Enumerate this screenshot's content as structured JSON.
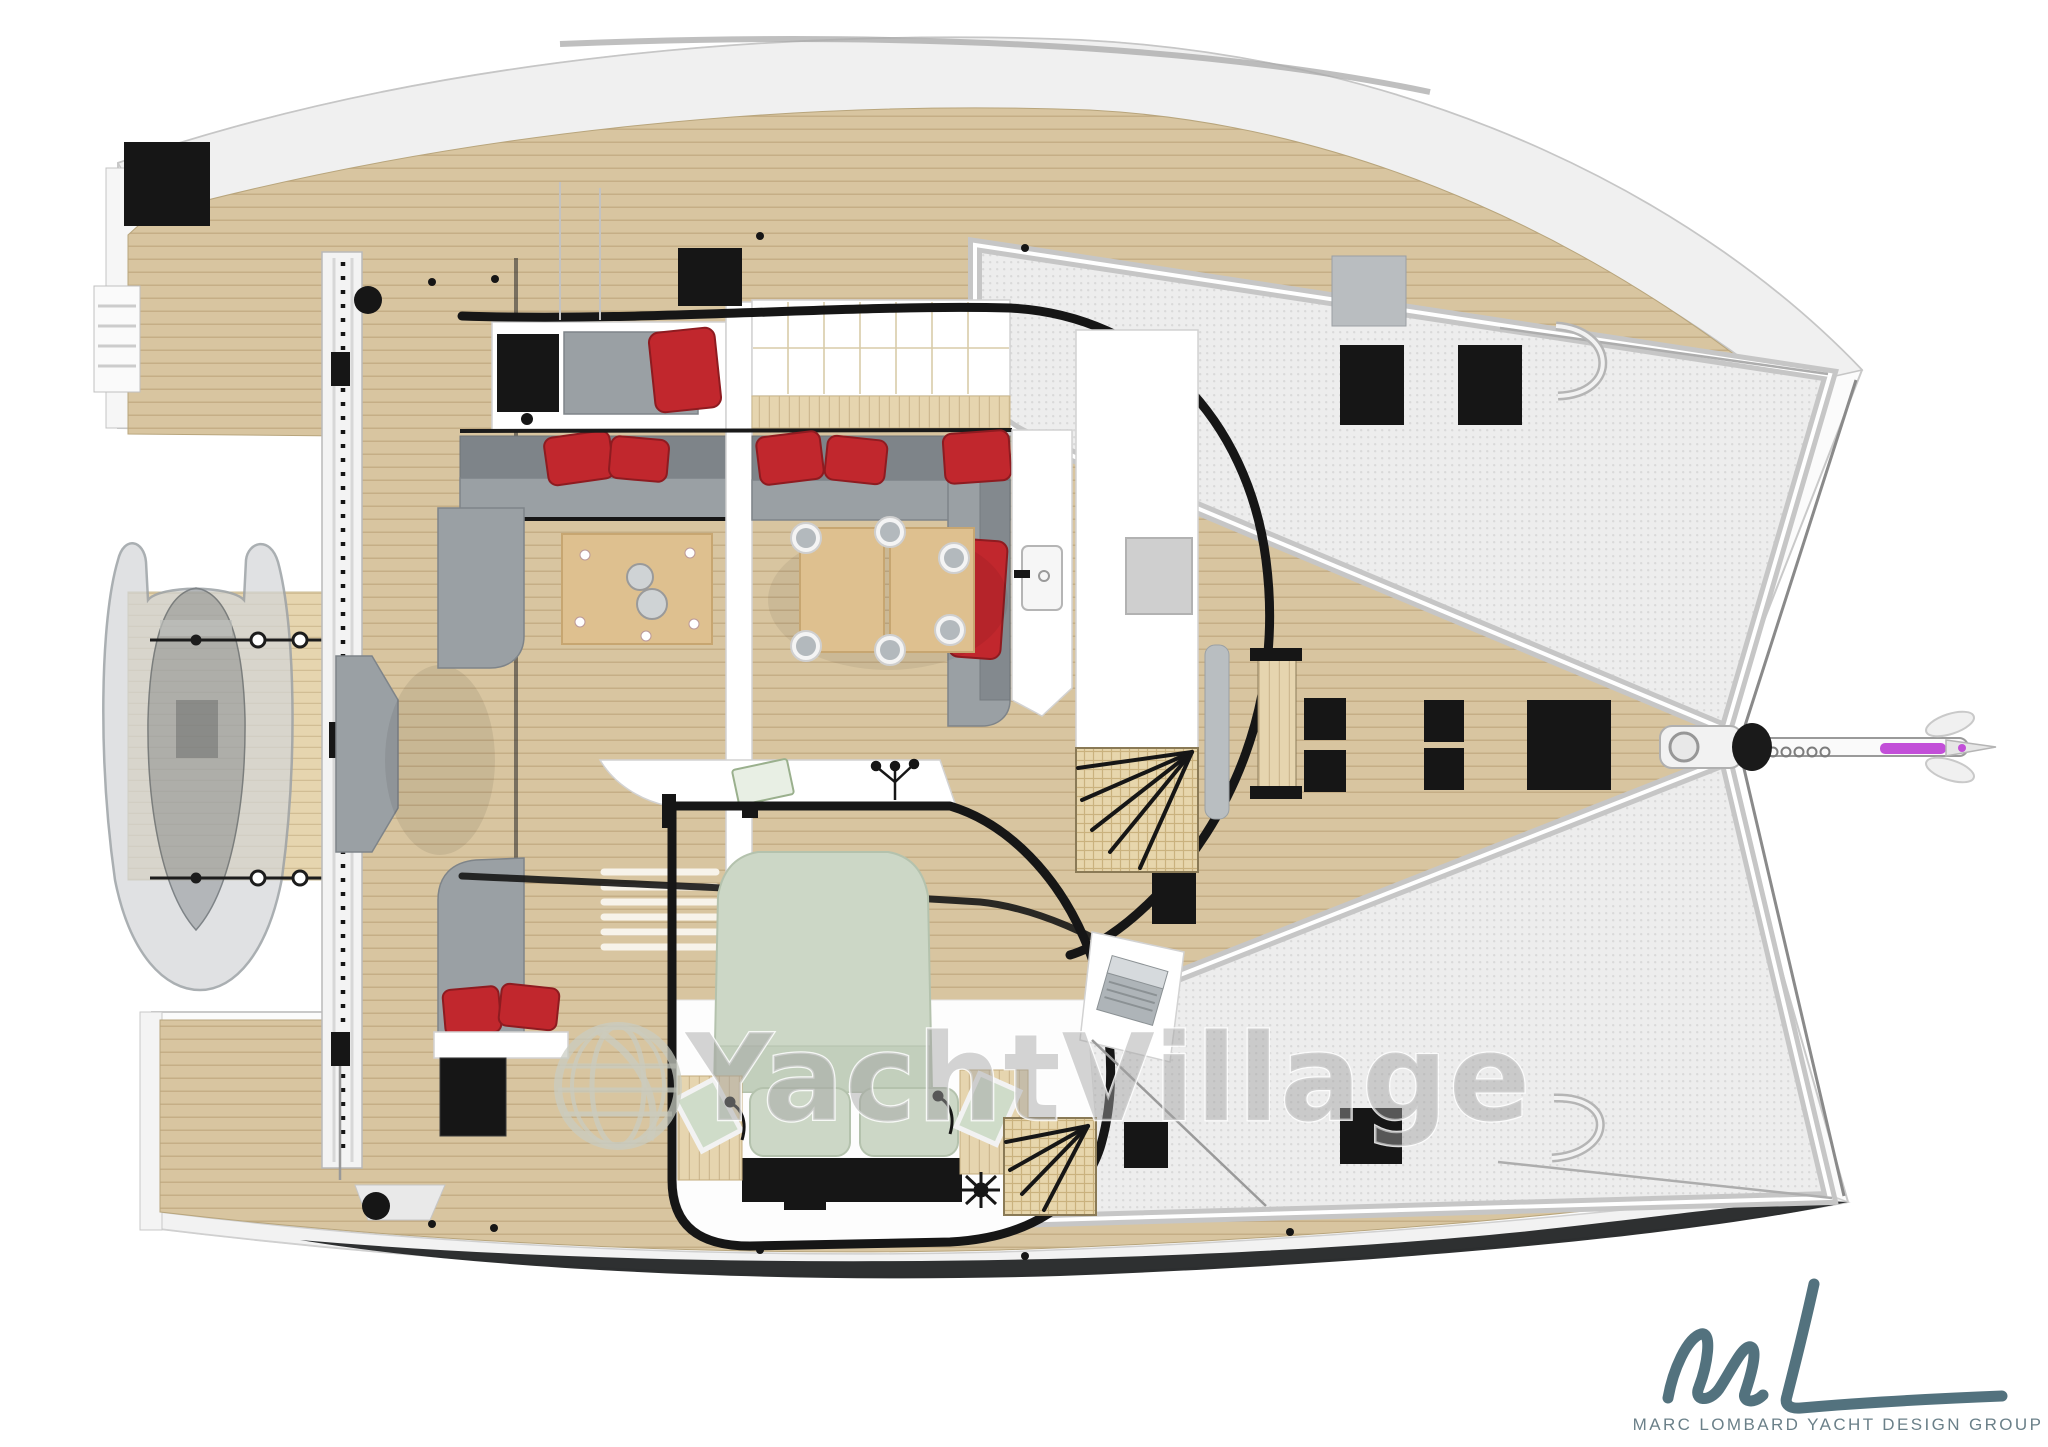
{
  "meta": {
    "title": "Sailing catamaran deck and interior plan — top view, bow to the right",
    "diagram_type": "yacht-deck-plan"
  },
  "watermark": {
    "text": "YachtVillage",
    "color": "#a2a2a2",
    "globe_icon": "globe-grid-icon"
  },
  "logo": {
    "monogram": "mL",
    "caption": "MARC LOMBARD YACHT DESIGN GROUP",
    "ink_color": "#53727e",
    "caption_color": "#6b8089"
  },
  "palette": {
    "paper": "#ffffff",
    "white": "#ffffff",
    "hullShade": "#f0f0f0",
    "hullStroke": "#c6c6c6",
    "hullDark": "#232526",
    "deckWood": "#d8c5a0",
    "deckLine": "#b2986c",
    "woodLight": "#e6d5af",
    "tableWood": "#dec08f",
    "tableStroke": "#c7a671",
    "mesh": "#ededed",
    "meshDot": "#d9d9d9",
    "meshBorder": "#c6c6c6",
    "grayCushion": "#9aa0a4",
    "grayDark": "#7e8489",
    "redCushion": "#c1272d",
    "redDark": "#8e1b20",
    "sageBed": "#ccd7c6",
    "sageDark": "#b4c2ad",
    "black": "#161616",
    "grayFitting": "#cfcfcf",
    "watermark": "#a2a2a2",
    "logoInk": "#53727e",
    "logoText": "#6b8089",
    "gennaker": "#c24fd8"
  },
  "zones": [
    {
      "id": "port-hull",
      "label": "port hull (top)"
    },
    {
      "id": "starboard-hull",
      "label": "starboard hull (bottom)"
    },
    {
      "id": "aft-beam",
      "label": "aft crossbeam with davits"
    },
    {
      "id": "swim-platform",
      "label": "aft teak platform"
    },
    {
      "id": "tender",
      "label": "dinghy stowed on davits"
    },
    {
      "id": "cockpit",
      "label": "aft cockpit lounge"
    },
    {
      "id": "coffee-table",
      "label": "cockpit coffee table"
    },
    {
      "id": "salon",
      "label": "salon with U-shaped sofa"
    },
    {
      "id": "dining-tables",
      "label": "twin dining tables with six seats"
    },
    {
      "id": "galley",
      "label": "galley counter"
    },
    {
      "id": "sink",
      "label": "galley sink"
    },
    {
      "id": "owners-cabin",
      "label": "owner's cabin"
    },
    {
      "id": "bed",
      "label": "double berth with sage bedding"
    },
    {
      "id": "nav-desk",
      "label": "desk with laptop"
    },
    {
      "id": "stairs-forward",
      "label": "companionway stairs forward"
    },
    {
      "id": "stairs-aft",
      "label": "companionway stairs aft"
    },
    {
      "id": "forward-cockpit",
      "label": "forward cockpit bench"
    },
    {
      "id": "foredeck",
      "label": "foredeck"
    },
    {
      "id": "trampoline-port",
      "label": "port trampoline"
    },
    {
      "id": "trampoline-starboard",
      "label": "starboard trampoline"
    },
    {
      "id": "bowsprit",
      "label": "bowsprit with windlass and furled gennaker"
    },
    {
      "id": "deck-hatches",
      "label": "black deck hatches"
    }
  ]
}
